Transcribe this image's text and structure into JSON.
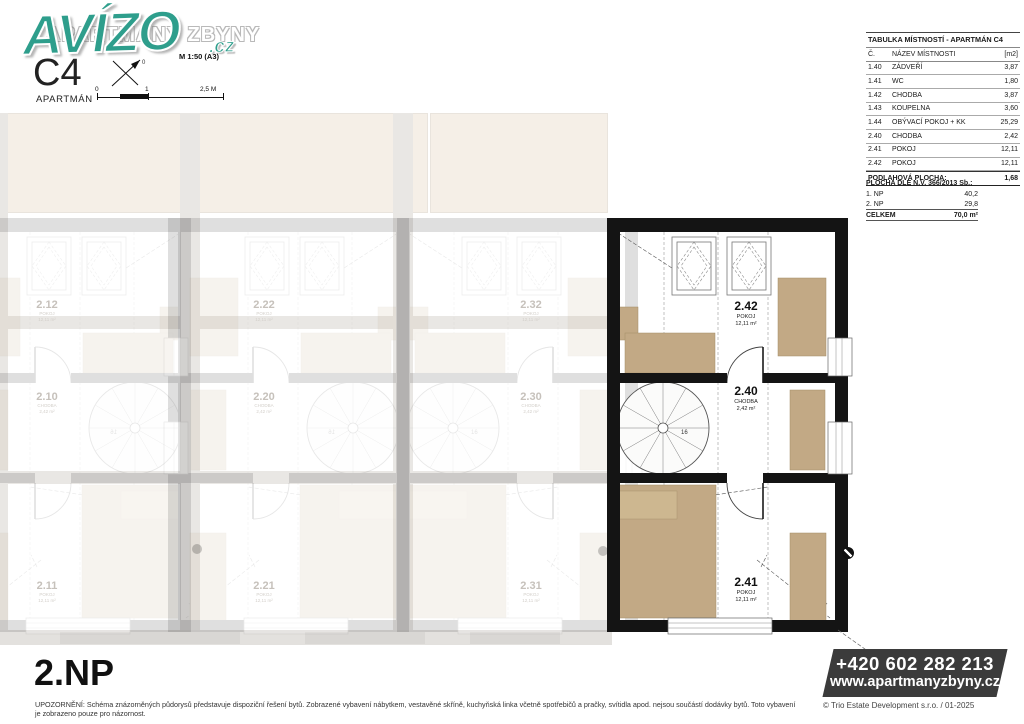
{
  "branding": {
    "logo": "AVÍZO",
    "logo_suffix": ".cz",
    "project_title": "APARTMÁNY ZBYNY",
    "scale_note": "M  1:50 (A3)"
  },
  "unit": {
    "code": "C4",
    "type_label": "APARTMÁN",
    "floor_label": "2.NP"
  },
  "scalebar": {
    "t0": "0",
    "t1": "1",
    "t2": "2,5 M"
  },
  "room_table": {
    "title": "TABULKA MÍSTNOSTÍ - APARTMÁN C4",
    "col_no": "Č.",
    "col_name": "NÁZEV MÍSTNOSTI",
    "col_area": "[m2]",
    "rows": [
      {
        "no": "1.40",
        "name": "ZÁDVEŘÍ",
        "area": "3,87"
      },
      {
        "no": "1.41",
        "name": "WC",
        "area": "1,80"
      },
      {
        "no": "1.42",
        "name": "CHODBA",
        "area": "3,87"
      },
      {
        "no": "1.43",
        "name": "KOUPELNA",
        "area": "3,60"
      },
      {
        "no": "1.44",
        "name": "OBÝVACÍ POKOJ + KK",
        "area": "25,29"
      },
      {
        "no": "2.40",
        "name": "CHODBA",
        "area": "2,42"
      },
      {
        "no": "2.41",
        "name": "POKOJ",
        "area": "12,11"
      },
      {
        "no": "2.42",
        "name": "POKOJ",
        "area": "12,11"
      }
    ],
    "total_label": "PODLAHOVÁ PLOCHA:",
    "total_value": "1,68"
  },
  "area_summary": {
    "title": "PLOCHA DLE N.V. 366/2013 Sb.:",
    "rows": [
      {
        "label": "1. NP",
        "value": "40,2"
      },
      {
        "label": "2. NP",
        "value": "29,8"
      }
    ],
    "total_label": "CELKEM",
    "total_value": "70,0 m²"
  },
  "plan": {
    "stair_steps": "16",
    "rooms": [
      {
        "num": "2.42",
        "name": "POKOJ",
        "area": "12,11 m²"
      },
      {
        "num": "2.40",
        "name": "CHODBA",
        "area": "2,42 m²"
      },
      {
        "num": "2.41",
        "name": "POKOJ",
        "area": "12,11 m²"
      }
    ]
  },
  "ghost_units": [
    {
      "num": "2.12",
      "name": "POKOJ",
      "area": "12,11 m²"
    },
    {
      "num": "2.22",
      "name": "POKOJ",
      "area": "12,11 m²"
    },
    {
      "num": "2.32",
      "name": "POKOJ",
      "area": "12,11 m²"
    },
    {
      "num": "2.10",
      "name": "CHODBA",
      "area": "2,42 m²"
    },
    {
      "num": "2.20",
      "name": "CHODBA",
      "area": "2,42 m²"
    },
    {
      "num": "2.30",
      "name": "CHODBA",
      "area": "2,42 m²"
    },
    {
      "num": "2.11",
      "name": "POKOJ",
      "area": "12,11 m²"
    },
    {
      "num": "2.21",
      "name": "POKOJ",
      "area": "12,11 m²"
    },
    {
      "num": "2.31",
      "name": "POKOJ",
      "area": "12,11 m²"
    }
  ],
  "contact": {
    "phone": "+420 602 282 213",
    "web": "www.apartmanyzbyny.cz"
  },
  "footer": {
    "notice": "UPOZORNĚNÍ:  Schéma znázorněných půdorysů představuje dispoziční řešení bytů. Zobrazené vybavení nábytkem, vestavěné skříně, kuchyňská linka včetně spotřebičů a pračky, svítidla apod. nejsou součástí dodávky bytů. Toto vybavení je zobrazeno pouze pro názornost.",
    "copyright": "© Trio Estate Development s.r.o. / 01-2025"
  },
  "colors": {
    "logo_teal": "#2e9e8c",
    "furniture_tan": "#c2a985",
    "wall_black": "#141414",
    "contact_bg": "#3b3b3b"
  }
}
